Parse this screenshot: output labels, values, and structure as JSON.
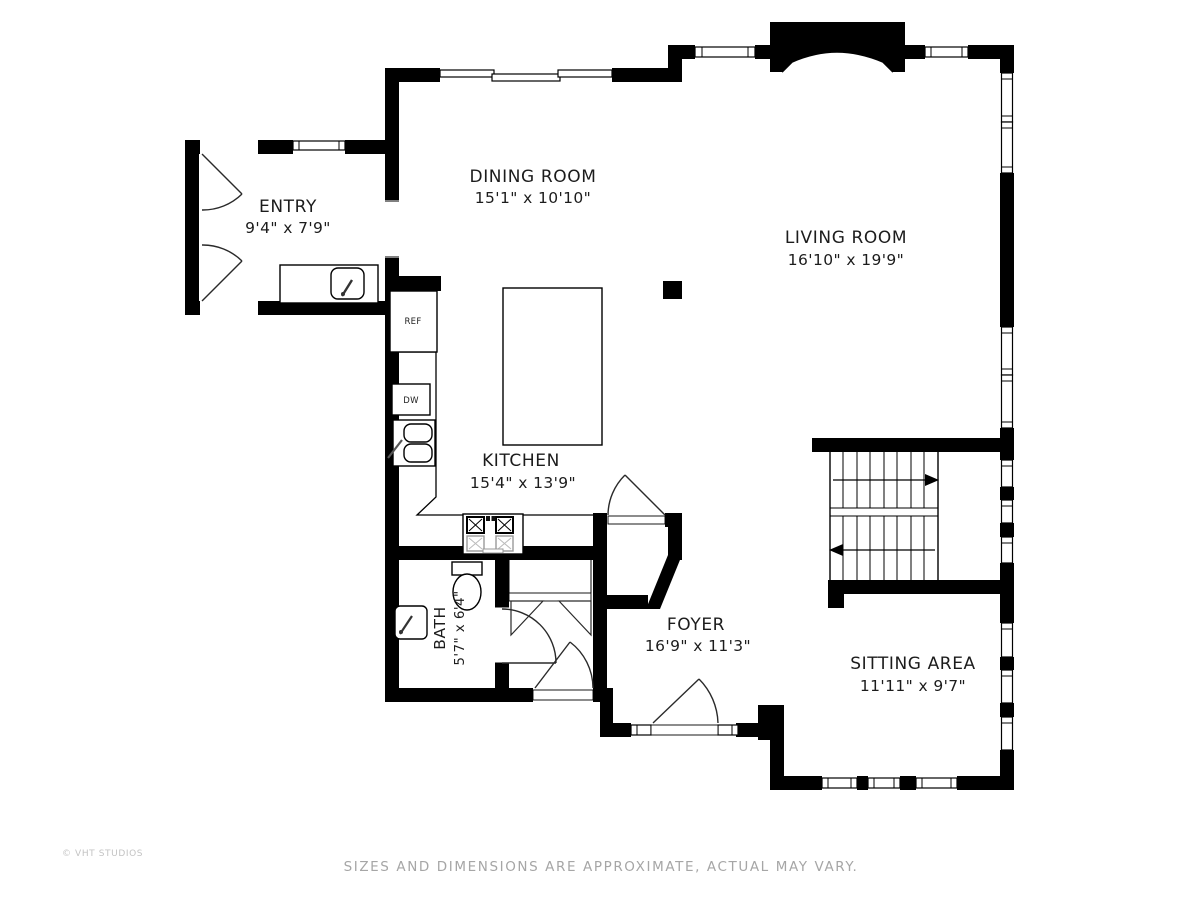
{
  "plan": {
    "type": "floor-plan",
    "wall_color": "#000000",
    "background": "#ffffff",
    "muted_text_color": "#a6a6a6"
  },
  "rooms": [
    {
      "id": "entry",
      "name": "ENTRY",
      "dimensions": "9'4\" x 7'9\""
    },
    {
      "id": "dining-room",
      "name": "DINING ROOM",
      "dimensions": "15'1\" x 10'10\""
    },
    {
      "id": "living-room",
      "name": "LIVING ROOM",
      "dimensions": "16'10\" x 19'9\""
    },
    {
      "id": "kitchen",
      "name": "KITCHEN",
      "dimensions": "15'4\" x 13'9\""
    },
    {
      "id": "bath",
      "name": "BATH",
      "dimensions": "5'7\" x 6'4\""
    },
    {
      "id": "foyer",
      "name": "FOYER",
      "dimensions": "16'9\" x 11'3\""
    },
    {
      "id": "sitting-area",
      "name": "SITTING AREA",
      "dimensions": "11'11\" x 9'7\""
    }
  ],
  "appliances": {
    "refrigerator": "REF",
    "dishwasher": "DW"
  },
  "footer": {
    "disclaimer": "SIZES AND DIMENSIONS ARE APPROXIMATE, ACTUAL MAY VARY.",
    "credit": "© VHT STUDIOS"
  }
}
